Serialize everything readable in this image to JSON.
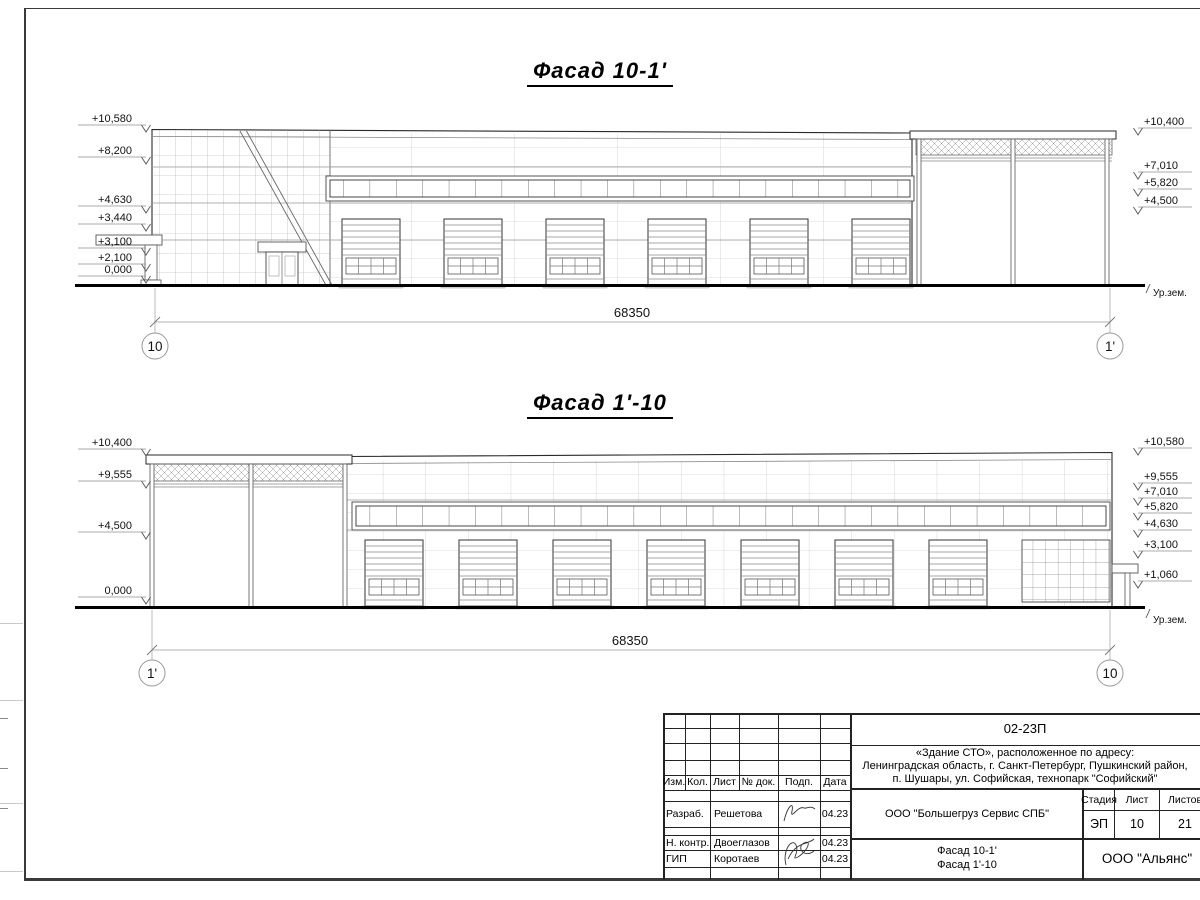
{
  "facade1": {
    "title": "Фасад 10-1'",
    "dimension": "68350",
    "axis_left": "10",
    "axis_right": "1'",
    "ground_label": "Ур.зем.",
    "levels_left": [
      "+10,580",
      "+8,200",
      "+4,630",
      "+3,440",
      "+3,100",
      "+2,100",
      "0,000"
    ],
    "levels_right": [
      "+10,400",
      "+7,010",
      "+5,820",
      "+4,500"
    ]
  },
  "facade2": {
    "title": "Фасад 1'-10",
    "dimension": "68350",
    "axis_left": "1'",
    "axis_right": "10",
    "ground_label": "Ур.зем.",
    "levels_left": [
      "+10,400",
      "+9,555",
      "+4,500",
      "0,000"
    ],
    "levels_right": [
      "+10,580",
      "+9,555",
      "+7,010",
      "+5,820",
      "+4,630",
      "+3,100",
      "+1,060"
    ]
  },
  "titleblock": {
    "code": "02-23П",
    "address_line1": "«Здание СТО», расположенное по адресу:",
    "address_line2": "Ленинградская область, г. Санкт-Петербург, Пушкинский район,",
    "address_line3": "п. Шушары, ул. Софийская, технопарк \"Софийский\"",
    "col_izm": "Изм.",
    "col_kol": "Кол.",
    "col_list": "Лист",
    "col_ndok": "№ док.",
    "col_podp": "Подп.",
    "col_data": "Дата",
    "row1_role": "Разраб.",
    "row1_name": "Решетова",
    "row1_date": "04.23",
    "row2_role": "Н. контр.",
    "row2_name": "Двоеглазов",
    "row2_date": "04.23",
    "row3_role": "ГИП",
    "row3_name": "Коротаев",
    "row3_date": "04.23",
    "company": "ООО \"Большегруз Сервис СПБ\"",
    "stage_label": "Стадия",
    "sheet_label": "Лист",
    "total_label": "Листов",
    "stage": "ЭП",
    "sheet_no": "10",
    "total": "21",
    "drawing_title1": "Фасад 10-1'",
    "drawing_title2": "Фасад 1'-10",
    "org": "ООО \"Альянс\""
  }
}
